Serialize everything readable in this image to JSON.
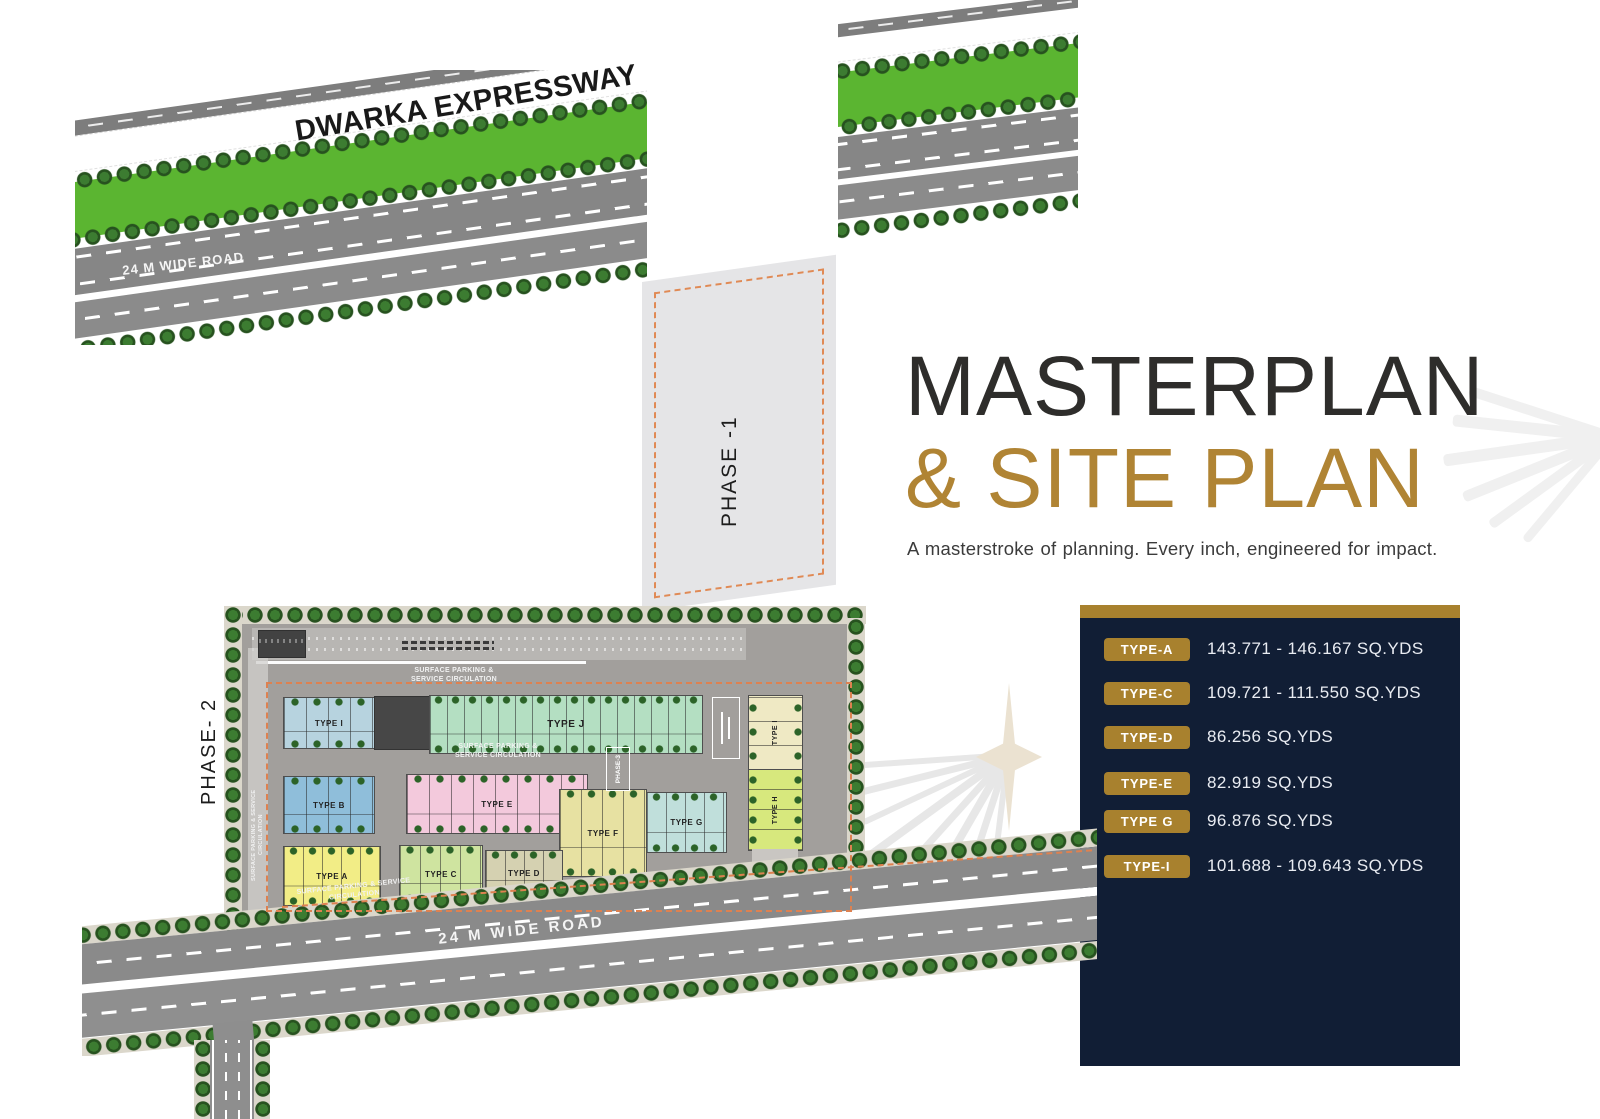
{
  "title": {
    "heading_dark": "MASTERPLAN",
    "heading_gold": "& SITE PLAN",
    "subtitle": "A masterstroke of planning. Every inch, engineered for impact."
  },
  "legend": {
    "rows": [
      {
        "badge": "TYPE-A",
        "value": "143.771 - 146.167 SQ.YDS"
      },
      {
        "badge": "TYPE-C",
        "value": "109.721 - 111.550 SQ.YDS"
      },
      {
        "badge": "TYPE-D",
        "value": "86.256 SQ.YDS"
      },
      {
        "badge": "TYPE-E",
        "value": "82.919 SQ.YDS"
      },
      {
        "badge": "TYPE G",
        "value": "96.876 SQ.YDS"
      },
      {
        "badge": "TYPE-I",
        "value": "101.688 - 109.643 SQ.YDS"
      }
    ],
    "colors": {
      "panel": "#111e35",
      "gold": "#a8812e",
      "text": "#e9ecf2"
    }
  },
  "map": {
    "roads": {
      "expressway": "DWARKA EXPRESSWAY",
      "road24m": "24 M WIDE ROAD"
    },
    "phases": {
      "p1": "PHASE -1",
      "p2": "PHASE- 2",
      "p3": "PHASE-3"
    },
    "notes": {
      "parking": "SURFACE PARKING & SERVICE CIRCULATION"
    },
    "blocks": {
      "i_top": {
        "label": "TYPE I",
        "color": "#b7d3df"
      },
      "j": {
        "label": "TYPE J",
        "color": "#b4dfc2"
      },
      "b": {
        "label": "TYPE B",
        "color": "#8fbeda"
      },
      "e": {
        "label": "TYPE E",
        "color": "#f3c9dc"
      },
      "f": {
        "label": "TYPE F",
        "color": "#e7e1a2"
      },
      "g": {
        "label": "TYPE G",
        "color": "#c0dfdb"
      },
      "a": {
        "label": "TYPE A",
        "color": "#f2ed86"
      },
      "c": {
        "label": "TYPE C",
        "color": "#cfe4a0"
      },
      "d": {
        "label": "TYPE D",
        "color": "#d5d1b1"
      },
      "i_strip": {
        "label": "TYPE I",
        "color": "#efe9c4"
      },
      "h": {
        "label": "TYPE H",
        "color": "#d7e87d"
      }
    },
    "colors": {
      "grass": "#5bb531",
      "tree": "#2e6328",
      "road": "#868686",
      "pavement": "#a29f9c",
      "dashed_boundary": "#de8150"
    }
  }
}
